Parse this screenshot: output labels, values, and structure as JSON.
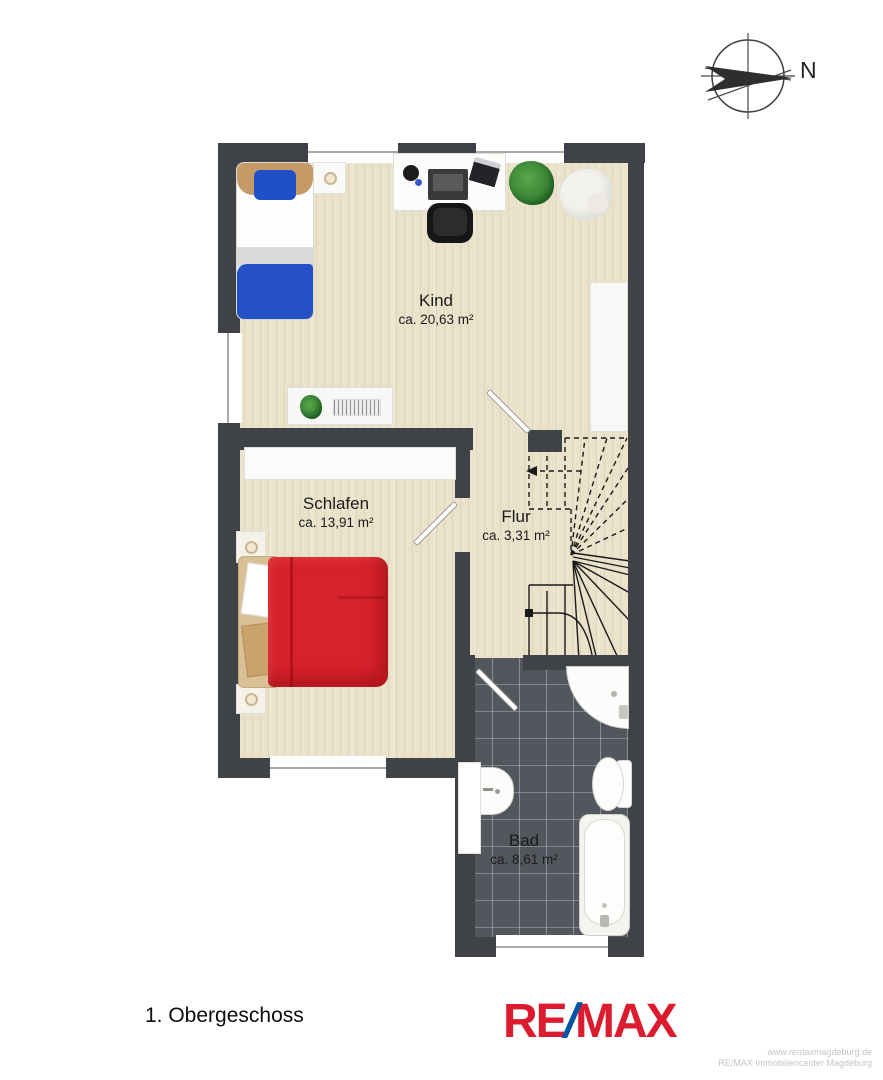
{
  "title": "1. Obergeschoss",
  "compass": {
    "label": "N"
  },
  "rooms": [
    {
      "name": "Kind",
      "area": "ca. 20,63 m²"
    },
    {
      "name": "Schlafen",
      "area": "ca. 13,91 m²"
    },
    {
      "name": "Flur",
      "area": "ca. 3,31 m²"
    },
    {
      "name": "Bad",
      "area": "ca. 8,61 m²"
    }
  ],
  "logo": {
    "re": "RE",
    "slash": "/",
    "max": "MAX"
  },
  "footer": {
    "line1": "www.remaxmagdeburg.de",
    "line2": "RE/MAX Immobiliencenter Magdeburg"
  },
  "colors": {
    "remax_red": "#DC1C2E",
    "remax_blue": "#0055A5",
    "wall": "#3F4247",
    "wood_floor": "#EAE2CB",
    "tile_floor": "#53565D",
    "bed_red": "#D7212C",
    "bed_blue": "#2451C6"
  }
}
